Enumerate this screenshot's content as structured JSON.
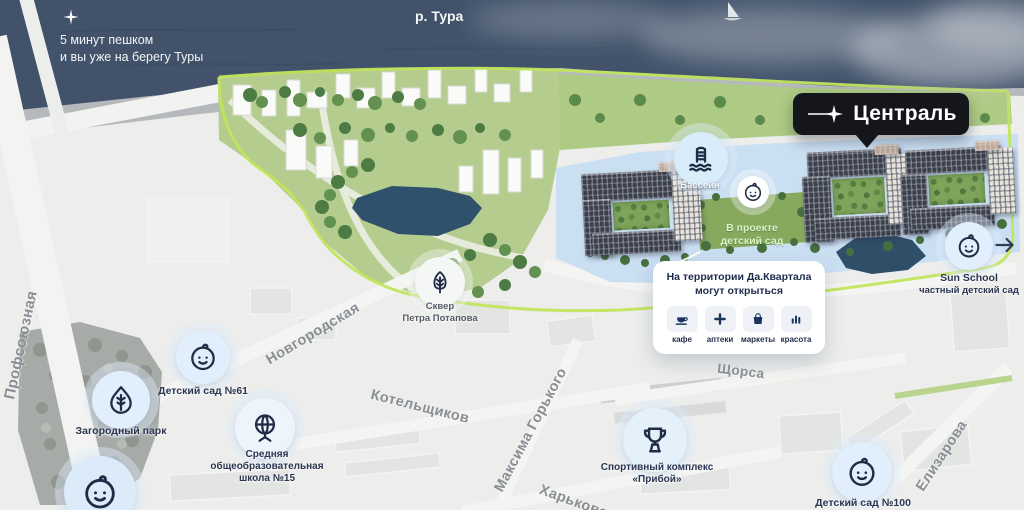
{
  "river": {
    "name": "р. Тура",
    "note_line1": "5 минут пешком",
    "note_line2": "и вы уже на берегу Туры"
  },
  "badge": {
    "label": "Централь",
    "icon": "sparkle-icon"
  },
  "complex": {
    "pool_label": "Бассейн",
    "kindergarten_plan_line1": "В проекте",
    "kindergarten_plan_line2": "детский сад"
  },
  "card": {
    "title_line1": "На территории Да.Квартала",
    "title_line2": "могут открыться",
    "items": [
      {
        "label": "кафе",
        "icon": "coffee-icon"
      },
      {
        "label": "аптеки",
        "icon": "pharmacy-plus-icon"
      },
      {
        "label": "маркеты",
        "icon": "shopping-bag-icon"
      },
      {
        "label": "красота",
        "icon": "beauty-icon"
      }
    ]
  },
  "sun_school": {
    "line1": "Sun School",
    "line2": "частный детский сад",
    "icon": "baby-icon"
  },
  "poi": {
    "skver": {
      "line1": "Сквер",
      "line2": "Петра Потапова",
      "icon": "leaf-icon"
    },
    "kindergarten61": {
      "label": "Детский сад №61",
      "icon": "baby-icon"
    },
    "country_park": {
      "label": "Загородный парк",
      "icon": "leaf-drop-icon"
    },
    "school15": {
      "line1": "Средняя",
      "line2": "общеобразовательная",
      "line3": "школа №15",
      "icon": "globe-icon"
    },
    "sport": {
      "line1": "Спортивный комплекс",
      "line2": "«Прибой»",
      "icon": "trophy-icon"
    },
    "kindergarten100": {
      "label": "Детский сад №100",
      "icon": "baby-icon"
    },
    "pool": {
      "icon": "pool-ladder-icon"
    }
  },
  "streets": {
    "profsoyuznaya": "Профсоюзная",
    "novgorodskaya": "Новгородская",
    "kotelshchikov": "Котельщиков",
    "maksima_gorkogo": "Максима Горького",
    "kharkovskaya": "Харьковская",
    "shchorsa": "Щорса",
    "elizarova": "Елизарова"
  },
  "colors": {
    "water": "#41526a",
    "land": "#edeeec",
    "park_green": "#b4cc8d",
    "accent_lime": "#c1e55d",
    "highlight_blue": "#cbdff3",
    "pond": "#2f516c",
    "navy": "#22304a",
    "badge_bg": "#14161c",
    "pin_blue": "#e1eefb",
    "street_text": "#898e95"
  }
}
